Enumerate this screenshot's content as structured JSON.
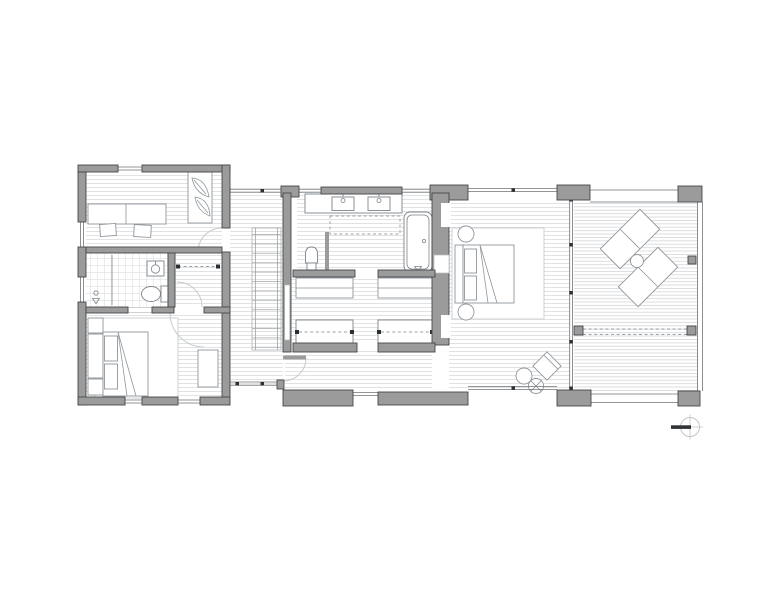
{
  "page": {
    "type": "architectural floor plan, upper level",
    "background": "#ffffff"
  },
  "colors": {
    "wall": "#9b9b9b",
    "wall_stroke": "#45484a",
    "floor_line": "#d8dbdd",
    "deck_line": "#d2d5d7",
    "tile_line": "#e1e4e6",
    "tread_line": "#b9bcbe",
    "glass": "#6f7478",
    "furniture": "#8f969c",
    "fixture": "#7d848a",
    "rug": "#cdd1d4",
    "dash": "#9aa0a4",
    "swing": "#c6cacc",
    "dot": "#2c2f31",
    "compass_ring": "#c2c5c7",
    "compass_needle": "#303335",
    "background": "#ffffff"
  },
  "rooms": [
    {
      "id": "office",
      "name": "office-study",
      "furniture": [
        "double desk",
        "two chairs",
        "wardrobe"
      ]
    },
    {
      "id": "bathroom",
      "name": "hall-bathroom",
      "furniture": [
        "shower with drain",
        "washbasin",
        "toilet"
      ]
    },
    {
      "id": "hall-closet",
      "name": "hall-closet",
      "furniture": [
        "hanging rod"
      ]
    },
    {
      "id": "bedroom",
      "name": "second-bedroom",
      "furniture": [
        "double bed",
        "two nightstands",
        "rug",
        "dresser"
      ]
    },
    {
      "id": "stair-hall",
      "name": "stair-hall",
      "furniture": [
        "staircase",
        "built-in shelf"
      ]
    },
    {
      "id": "master-bathroom",
      "name": "master-bathroom",
      "furniture": [
        "double vanity",
        "mirror",
        "toilet",
        "bathtub"
      ]
    },
    {
      "id": "closet-left",
      "name": "walk-in-closet-left",
      "furniture": [
        "island dresser",
        "hanging rod"
      ]
    },
    {
      "id": "closet-right",
      "name": "walk-in-closet-right",
      "furniture": [
        "island dresser",
        "hanging rod"
      ]
    },
    {
      "id": "master-bedroom",
      "name": "master-bedroom",
      "furniture": [
        "double bed",
        "two round nightstands",
        "rug",
        "armchair",
        "round side table",
        "drinks table"
      ]
    },
    {
      "id": "deck",
      "name": "roof-deck",
      "furniture": [
        "two lounge chairs",
        "round table",
        "guard rail"
      ]
    }
  ],
  "symbols": {
    "north_arrow": "compass circle with solid west-pointing needle"
  }
}
